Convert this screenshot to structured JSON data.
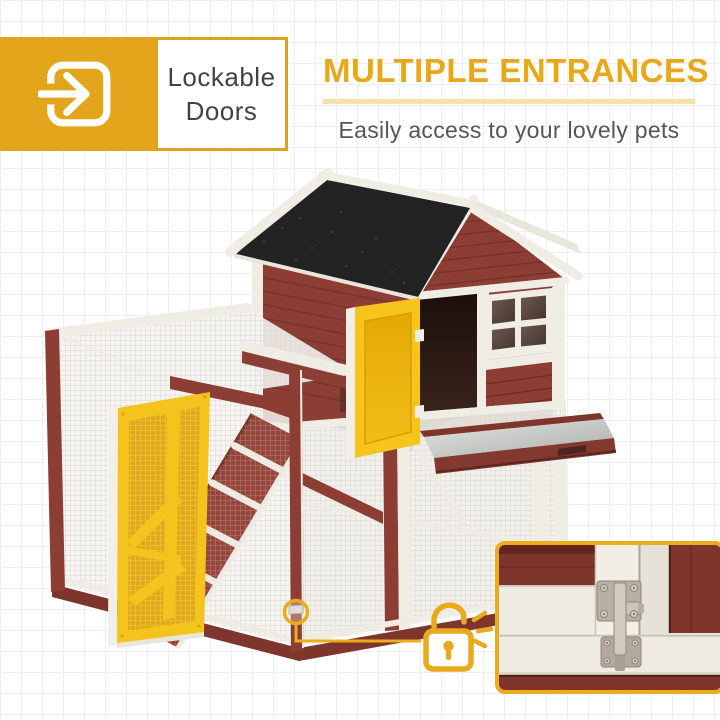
{
  "page": {
    "width": 720,
    "height": 720,
    "background": "white with faint grid"
  },
  "badge": {
    "icon": "door-enter-arrow-icon",
    "line1": "Lockable",
    "line2": "Doors"
  },
  "headline": {
    "title": "MULTIPLE ENTRANCES",
    "subtitle": "Easily access to your lovely pets"
  },
  "callout": {
    "icon": "open-padlock-icon",
    "marker": "latch-marker-circle"
  },
  "inset": {
    "content": "door-latch-closeup"
  },
  "colors": {
    "badge_yellow": "#e2a51b",
    "heading_gold": "#e8a817",
    "divider_yellow": "#f6e3a6",
    "text_gray": "#55565a",
    "label_text": "#424348",
    "outline_gold": "#ecac1c",
    "coop_red": "#8c3e35",
    "coop_red_dark": "#73302a",
    "trim_white": "#f0ede5",
    "roof_black": "#232323",
    "door_yellow": "#f7c41c",
    "door_yellow_deep": "#e9af0a",
    "mesh_line": "#d9d7d1",
    "metal_gray": "#c7cac6"
  }
}
